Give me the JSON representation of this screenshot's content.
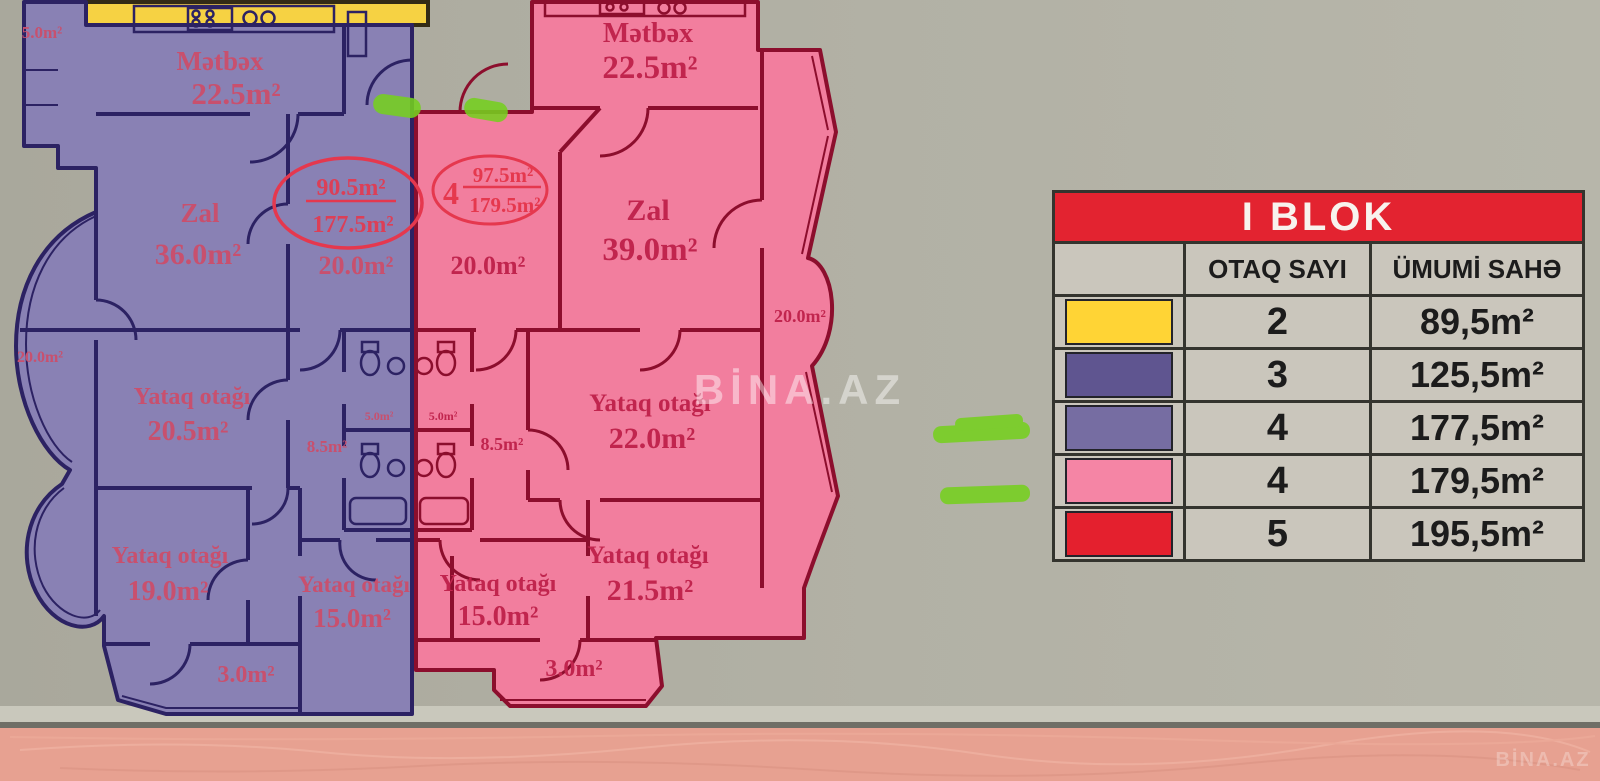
{
  "plan": {
    "purple_unit": {
      "balcony_top": "5.0m²",
      "kitchen_name": "Mətbəx",
      "kitchen_area": "22.5m²",
      "hall_name": "Zal",
      "hall_area": "36.0m²",
      "foyer_area": "20.0m²",
      "bay_area": "20.0m²",
      "bedroom1_name": "Yataq otağı",
      "bedroom1_area": "20.5m²",
      "bedroom2_name": "Yataq otağı",
      "bedroom2_area": "19.0m²",
      "bedroom3_name": "Yataq otağı",
      "bedroom3_area": "15.0m²",
      "corridor_area": "8.5m²",
      "bath_area": "5.0m²",
      "balcony_bottom": "3.0m²",
      "annotation": {
        "living": "90.5m²",
        "total": "177.5m²"
      }
    },
    "pink_unit": {
      "kitchen_name": "Mətbəx",
      "kitchen_area": "22.5m²",
      "hall_name": "Zal",
      "hall_area": "39.0m²",
      "foyer_area": "20.0m²",
      "bay_area": "20.0m²",
      "bedroom1_name": "Yataq otağı",
      "bedroom1_area": "22.0m²",
      "bedroom2_name": "Yataq otağı",
      "bedroom2_area": "21.5m²",
      "bedroom3_name": "Yataq otağı",
      "bedroom3_area": "15.0m²",
      "corridor_area": "8.5m²",
      "bath_area": "5.0m²",
      "balcony_bottom": "3.0m²",
      "annotation": {
        "rooms": "4",
        "living": "97.5m²",
        "total": "179.5m²"
      }
    }
  },
  "table": {
    "title": "I BLOK",
    "col_rooms": "OTAQ SAYI",
    "col_area": "ÜMUMİ SAHƏ",
    "rows": [
      {
        "color": "#FFD435",
        "rooms": "2",
        "area": "89,5m²"
      },
      {
        "color": "#5F5590",
        "rooms": "3",
        "area": "125,5m²"
      },
      {
        "color": "#766DA2",
        "rooms": "4",
        "area": "177,5m²"
      },
      {
        "color": "#F585A5",
        "rooms": "4",
        "area": "179,5m²"
      },
      {
        "color": "#E4202E",
        "rooms": "5",
        "area": "195,5m²"
      }
    ]
  },
  "watermark": {
    "center": "BİNA.AZ",
    "corner": "BİNA.AZ"
  },
  "colors": {
    "board": "#b0afa3",
    "floor": "#e7a191",
    "yellow_fill": "#f6d243",
    "purple_fill": "#8981b4",
    "purple_line": "#2c2263",
    "purple_text": "#c8506e",
    "pink_fill": "#f27e9e",
    "pink_line": "#8c0e2d",
    "pink_text": "#c1254e",
    "annotation_red": "#e5384e",
    "highlighter_green": "#76d01f",
    "table_header_red": "#e32330",
    "table_cell_gray": "#cac6bc"
  }
}
